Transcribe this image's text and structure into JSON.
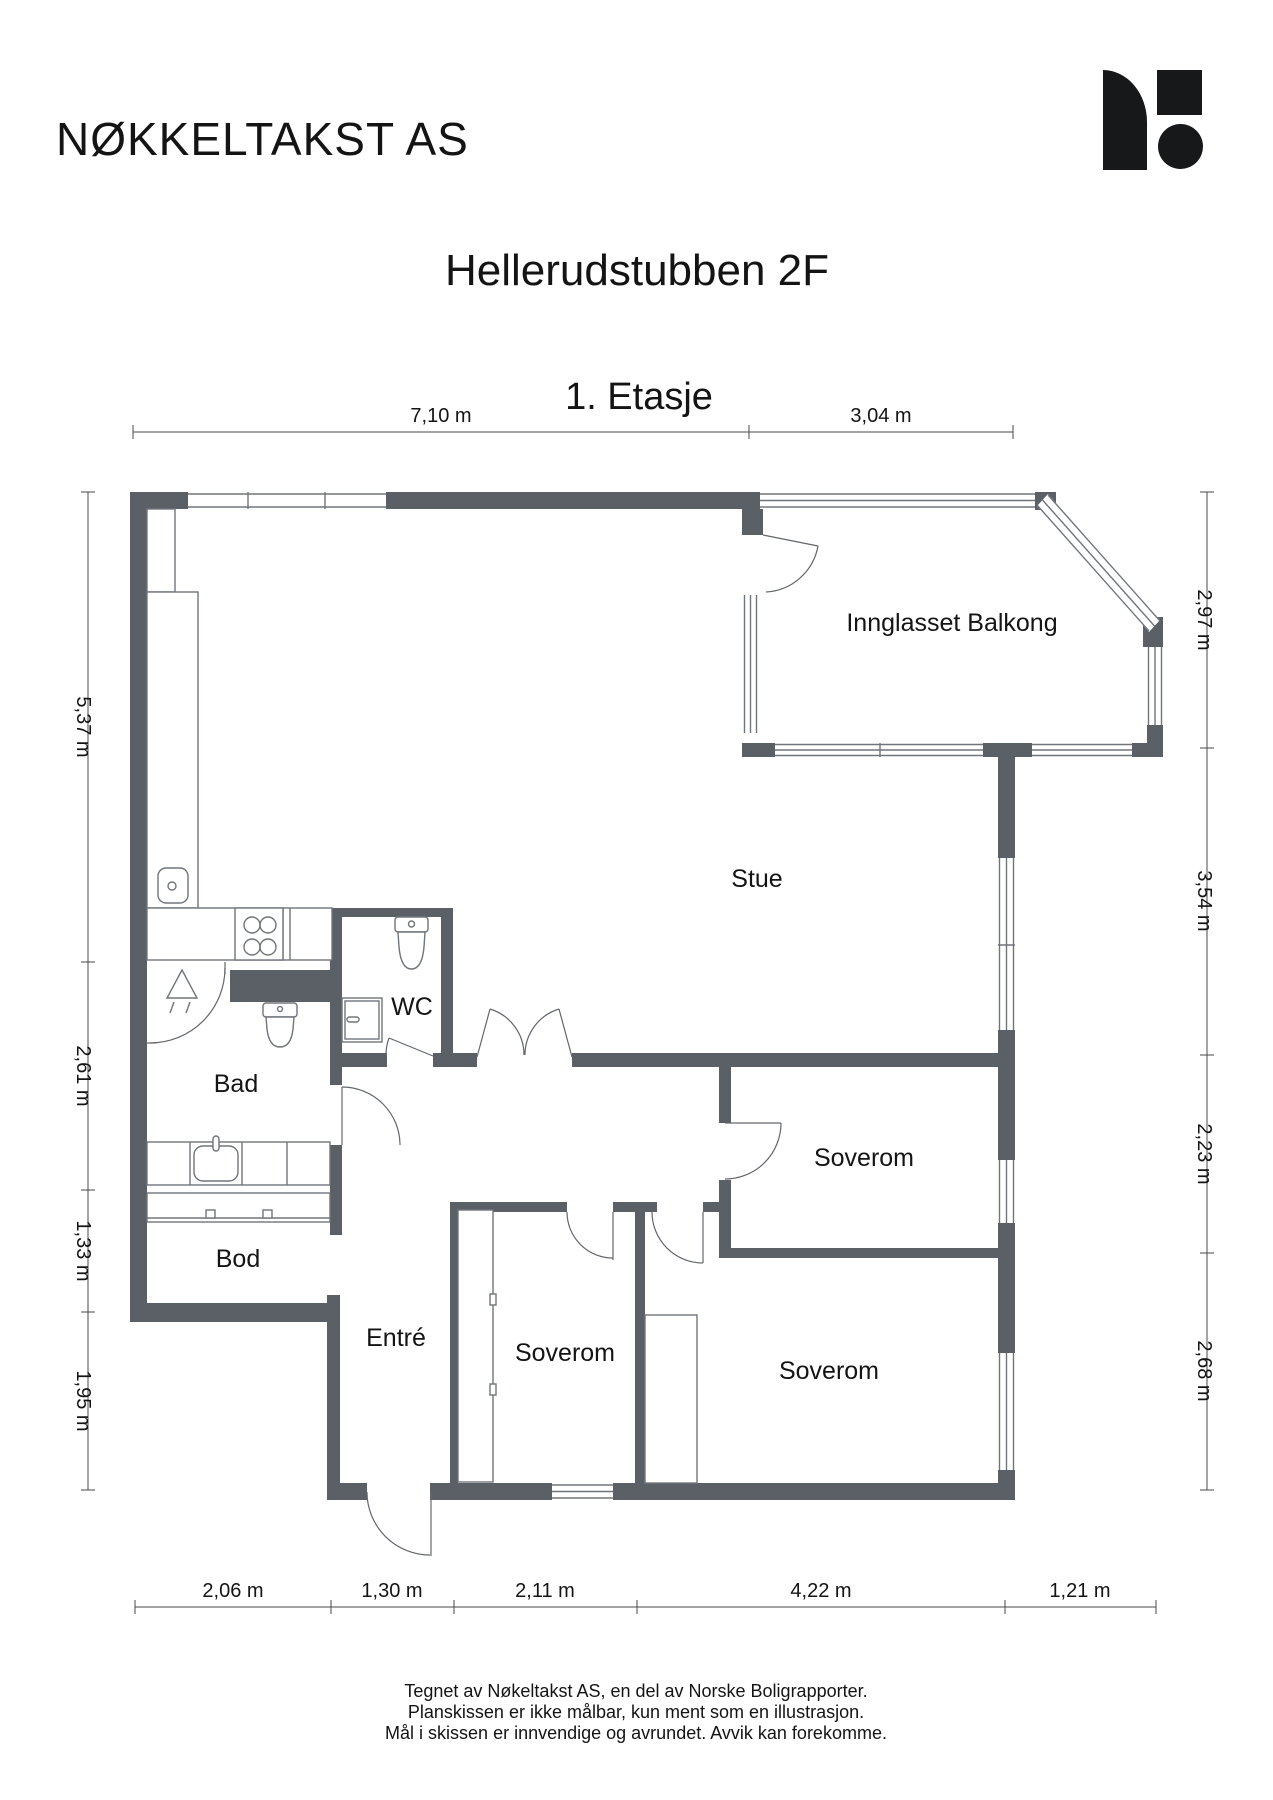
{
  "header": {
    "company": "NØKKELTAKST AS",
    "title": "Hellerudstubben 2F",
    "subtitle": "1. Etasje"
  },
  "rooms": {
    "balcony": "Innglasset Balkong",
    "living": "Stue",
    "wc": "WC",
    "bath": "Bad",
    "storage": "Bod",
    "entry": "Entré",
    "bedroom_mid_right": "Soverom",
    "bedroom_mid": "Soverom",
    "bedroom_right": "Soverom"
  },
  "dimensions": {
    "top": [
      "7,10 m",
      "3,04 m"
    ],
    "left": [
      "5,37 m",
      "2,61 m",
      "1,33 m",
      "1,95 m"
    ],
    "right": [
      "2,97 m",
      "3,54 m",
      "2,23 m",
      "2,68 m"
    ],
    "bottom": [
      "2,06 m",
      "1,30 m",
      "2,11 m",
      "4,22 m",
      "1,21 m"
    ]
  },
  "footer": {
    "line1": "Tegnet av Nøkeltakst AS, en del av Norske Boligrapporter.",
    "line2": "Planskissen er ikke målbar, kun ment som en illustrasjon.",
    "line3": "Mål i skissen er innvendige og avrundet. Avvik kan forekomme."
  },
  "colors": {
    "wall": "#5b6066",
    "line": "#70757a",
    "text": "#141414"
  }
}
